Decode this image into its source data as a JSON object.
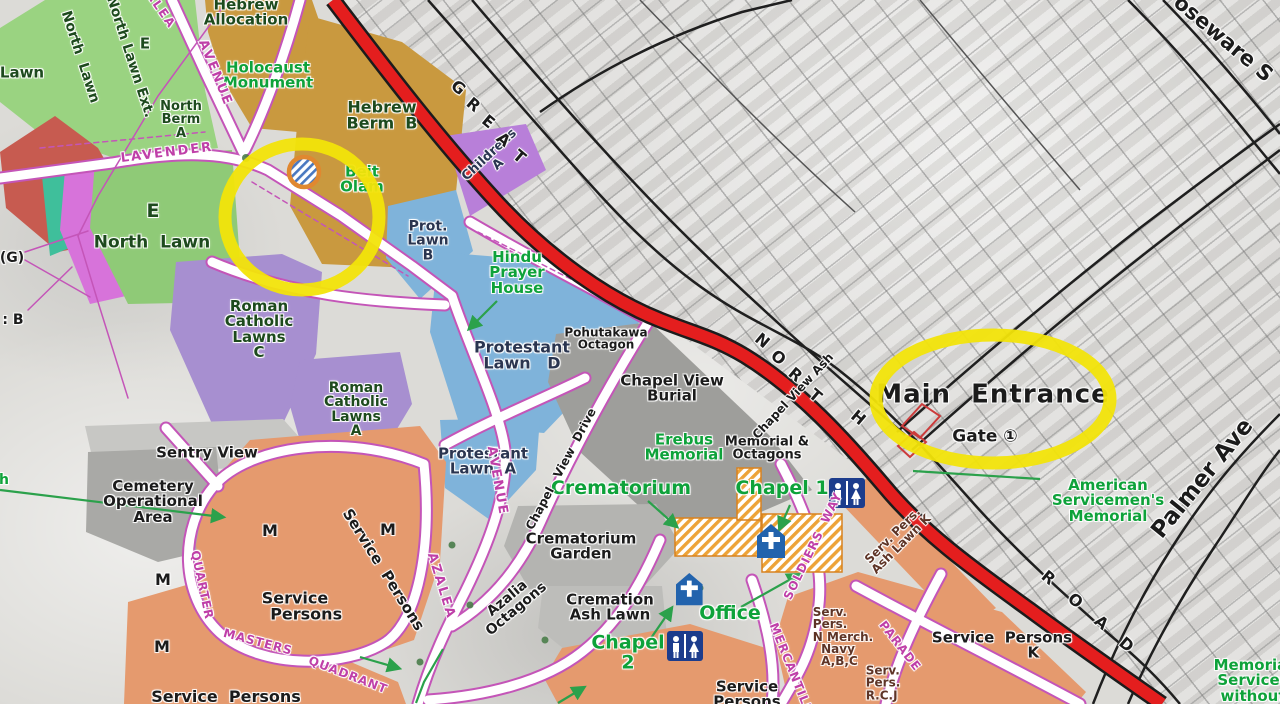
{
  "map_type": "cemetery plan over aerial photo",
  "labels": {
    "hebrew_allocation": "Hebrew\nAllocation",
    "holocaust_monument": "Holocaust\nMonument",
    "hebrew_berm_b": "Hebrew\nBerm  B",
    "beit_olam": "Beit\nOlam",
    "north_lawn_rot": "North  Lawn",
    "north_lawn_ext_rot": "North Lawn Ext.",
    "lawn_left": "Lawn",
    "e_top": "E",
    "north_berm_a": "North\nBerm\nA",
    "e_mid": "E",
    "north_lawn_mid": "North  Lawn",
    "g_paren": "(G)",
    "b_colon": ": B",
    "h_green": "h",
    "childrens_a": "Childrens\nA",
    "prot_lawn_b": "Prot.\nLawn\nB",
    "hindu_prayer_house": "Hindu\nPrayer\nHouse",
    "protestant_lawn_d": "Protestant\nLawn   D",
    "pohutakawa_octagon": "Pohutakawa\nOctagon",
    "chapel_view_burial": "Chapel View\nBurial",
    "erebus_memorial": "Erebus\nMemorial",
    "memorial_octagons": "Memorial &\nOctagons",
    "protestant_lawn_a": "Protestant\nLawn  A",
    "roman_catholic_lawns_c": "Roman\nCatholic\nLawns\nC",
    "roman_catholic_lawns_a": "Roman\nCatholic\nLawns\nA",
    "sentry_view": "Sentry View",
    "cemetery_operational_area": "Cemetery\nOperational\nArea",
    "m": "M",
    "service_persons_quadrant": "Service\n    Persons",
    "service_persons_diag": "Service  Persons",
    "service_persons_bottom_left": "Service  Persons",
    "service_persons_bottom_center": "Service\nPersons",
    "service_persons_k": "Service  Persons\n            K",
    "azalia_octagons": "Azalia\nOctagons",
    "crematorium_garden": "Crematorium\nGarden",
    "cremation_ash_lawn": "Cremation\nAsh Lawn",
    "crematorium": "Crematorium",
    "chapel_1": "Chapel 1",
    "chapel_2": "Chapel\n2",
    "office": "Office",
    "serv_pers_ash_lawn_k": "Serv. Pers.\nAsh Lawn K",
    "serv_pers_merch_navy": "Serv.\nPers.\nN Merch.\n  Navy\n  A,B,C",
    "serv_pers_rcj": "Serv.\nPers.\nR.C.J",
    "main_entrance": "Main  Entrance",
    "gate_1": "Gate ①",
    "american_servicemens_memorial": "American\nServicemen's\nMemorial",
    "palmer_ave": "Palmer Ave",
    "roseware": "oseware S",
    "memorial_services_without": "Memorial\nServices\nwithout",
    "chapel_view_drive": "Chapel   View  Drive",
    "chapel_view_ash": "Chapel View Ash"
  },
  "roads": {
    "lavender": "LAVENDER",
    "avenue_upper": "AVENUE",
    "alea_upper": "ALEA",
    "avenue_mid": "AVENUE",
    "azalea_mid": "AZALEA",
    "quarter": "QUARTER",
    "masters": "MASTERS",
    "quadrant": "QUADRANT",
    "soldiers_way": "SOLDIERS  WAY",
    "mercantile": "MERCANTILE",
    "parade": "PARADE"
  },
  "streets": {
    "great": "GREAT",
    "north": "NORTH",
    "road": "ROAD"
  },
  "icons": {
    "toilets": "toilets-icon (male/female figures on blue square)",
    "chapel": "chapel-icon (blue building with white cross)",
    "beit_olam_symbol": "striped-circle-icon",
    "gate_marker": "red outlined gate shape",
    "highlight": "yellow ellipse highlight"
  },
  "colors": {
    "highlight_yellow": "#f2e40a",
    "main_road_red": "#e41e1e",
    "road_pink": "#c455b8",
    "lawn_green": "#96cf7f",
    "hebrew_tan": "#c9993f",
    "catholic_purple": "#a78fd0",
    "protestant_blue": "#7fb3da",
    "service_salmon": "#e59a6e",
    "childrens_purple": "#b87fd9",
    "magenta_plot": "#d773da",
    "red_plot": "#c75b50",
    "teal_plot": "#3fbf9b",
    "label_green": "#0ea23a",
    "label_pink": "#bf3fa8",
    "chapel_blue": "#2263ad"
  }
}
